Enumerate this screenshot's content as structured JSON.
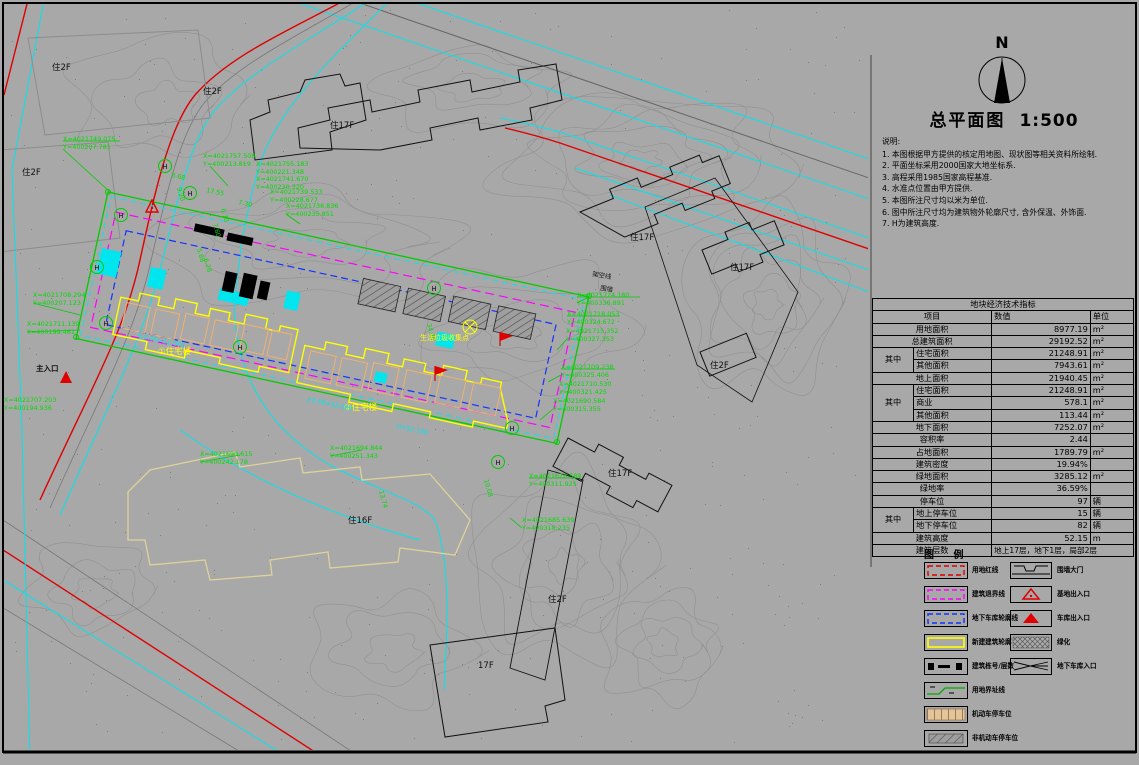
{
  "title_block": {
    "north_label": "N",
    "title": "总平面图",
    "scale": "1:500"
  },
  "notes": {
    "heading": "说明:",
    "items": [
      "1. 本图根据甲方提供的核定用地图、现状图等相关资料所绘制.",
      "2. 平面坐标采用2000国家大地坐标系.",
      "3. 高程采用1985国家高程基准.",
      "4. 水准点位置由甲方提供.",
      "5. 本图所注尺寸均以米为单位.",
      "6. 图中所注尺寸均为建筑物外轮廓尺寸, 含外保温、外饰面.",
      "7. H为建筑高度."
    ]
  },
  "table": {
    "title": "地块经济技术指标",
    "headers": {
      "item": "项目",
      "value": "数值",
      "unit": "单位"
    },
    "rows": [
      {
        "item": "用地面积",
        "value": "8977.19",
        "unit": "m²"
      },
      {
        "item": "总建筑面积",
        "value": "29192.52",
        "unit": "m²"
      },
      {
        "group": "其中",
        "item": "住宅面积",
        "value": "21248.91",
        "unit": "m²"
      },
      {
        "item": "其他面积",
        "value": "7943.61",
        "unit": "m²"
      },
      {
        "item": "地上面积",
        "value": "21940.45",
        "unit": "m²"
      },
      {
        "group": "其中",
        "item": "住宅面积",
        "value": "21248.91",
        "unit": "m²"
      },
      {
        "item": "商业",
        "value": "578.1",
        "unit": "m²"
      },
      {
        "item": "其他面积",
        "value": "113.44",
        "unit": "m²"
      },
      {
        "item": "地下面积",
        "value": "7252.07",
        "unit": "m²"
      },
      {
        "item": "容积率",
        "value": "2.44",
        "unit": ""
      },
      {
        "item": "占地面积",
        "value": "1789.79",
        "unit": "m²"
      },
      {
        "item": "建筑密度",
        "value": "19.94%",
        "unit": ""
      },
      {
        "item": "绿地面积",
        "value": "3285.12",
        "unit": "m²"
      },
      {
        "item": "绿地率",
        "value": "36.59%",
        "unit": ""
      },
      {
        "item": "停车位",
        "value": "97",
        "unit": "辆"
      },
      {
        "group": "其中",
        "item": "地上停车位",
        "value": "15",
        "unit": "辆"
      },
      {
        "item": "地下停车位",
        "value": "82",
        "unit": "辆"
      },
      {
        "item": "建筑高度",
        "value": "52.15",
        "unit": "m"
      },
      {
        "item": "建筑层数",
        "value": "地上17层，地下1层，局部2层",
        "unit": ""
      }
    ]
  },
  "legend": {
    "title": "图  例",
    "left": [
      {
        "label": "用地红线"
      },
      {
        "label": "建筑退界线"
      },
      {
        "label": "地下车库轮廓线"
      },
      {
        "label": "新建建筑轮廓"
      },
      {
        "label": "建筑栋号/层数"
      },
      {
        "label": "用地界址线"
      },
      {
        "label": "机动车停车位"
      },
      {
        "label": "非机动车停车位"
      }
    ],
    "right": [
      {
        "label": "围墙大门"
      },
      {
        "label": "基地出入口"
      },
      {
        "label": "车库出入口"
      },
      {
        "label": "绿化"
      },
      {
        "label": "地下车库入口"
      }
    ]
  },
  "drawing": {
    "coords": [
      {
        "l1": "X=4021749.075",
        "l2": "Y=400207.781"
      },
      {
        "l1": "X=4021757.508",
        "l2": "Y=400213.819"
      },
      {
        "l1": "X=4021755.183",
        "l2": "Y=400221.348"
      },
      {
        "l1": "X=4021741.670",
        "l2": "Y=400230.320"
      },
      {
        "l1": "X=4021739.533",
        "l2": "Y=400228.677"
      },
      {
        "l1": "X=4021736.836",
        "l2": "Y=400235.851"
      },
      {
        "l1": "X=4021708.294",
        "l2": "Y=400207.123"
      },
      {
        "l1": "X=4021711.139",
        "l2": "Y=400199.461"
      },
      {
        "l1": "X=4021707.203",
        "l2": "Y=400194.936"
      },
      {
        "l1": "X=4021699.615",
        "l2": "Y=400242.178"
      },
      {
        "l1": "X=4021694.844",
        "l2": "Y=400251.343"
      },
      {
        "l1": "X=4021724.180",
        "l2": "Y=400336.891"
      },
      {
        "l1": "X=4021718.053",
        "l2": "Y=400324.672"
      },
      {
        "l1": "X=4021715.352",
        "l2": "Y=400327.353"
      },
      {
        "l1": "X=4021709.238",
        "l2": "Y=400325.406"
      },
      {
        "l1": "X=4021710.530",
        "l2": "Y=400321.425"
      },
      {
        "l1": "X=4021690.584",
        "l2": "Y=400315.355"
      },
      {
        "l1": "X=4021676.589",
        "l2": "Y=400311.925"
      },
      {
        "l1": "X=4021685.639",
        "l2": "Y=400318.235"
      }
    ],
    "dims": [
      "8.68",
      "9.20",
      "17.55",
      "6.70",
      "7.30",
      "7.60",
      "5.88",
      "6.28",
      "34.48",
      "13.74",
      "10.08"
    ],
    "buildings": [
      "住2F",
      "住2F",
      "住2F",
      "住17F",
      "住17F",
      "住17F",
      "住2F",
      "住16F",
      "住17F",
      "住2F",
      "17F"
    ],
    "site_labels": {
      "b1": "①住宅楼",
      "b2": "②住宅楼",
      "waste": "生活垃圾收集点",
      "gate": "主入口",
      "elev1": "±0.00=52.000",
      "elev2": "H=52.150",
      "elev3": "±0.00=52.000",
      "wall": "围墙",
      "power": "架空线",
      "h": "H"
    }
  }
}
